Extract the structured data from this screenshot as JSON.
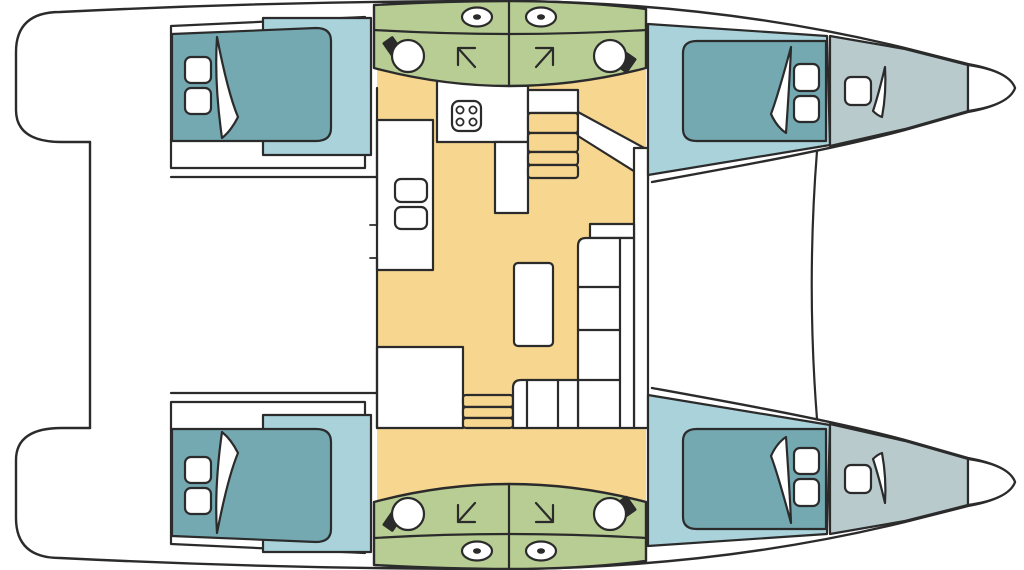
{
  "diagram": {
    "type": "catamaran-floor-plan",
    "orientation": {
      "bow": "right",
      "stern": "left"
    },
    "palette": {
      "outline": "#2b2b2b",
      "hull_white": "#ffffff",
      "floor_orange": "#f7d78f",
      "bathroom_green": "#b8cd93",
      "cabin_teal": "#a9d2da",
      "bed_teal": "#74a9b2",
      "bow_gray": "#b9cacd"
    },
    "rooms": [
      {
        "name": "cockpit-aft",
        "fill": "hull_white"
      },
      {
        "name": "saloon-galley",
        "fill": "floor_orange"
      },
      {
        "name": "aft-cabin-top-hull",
        "fill": "cabin_teal"
      },
      {
        "name": "forward-cabin-top-hull",
        "fill": "cabin_teal"
      },
      {
        "name": "aft-cabin-bottom-hull",
        "fill": "cabin_teal"
      },
      {
        "name": "forward-cabin-bottom-hull",
        "fill": "cabin_teal"
      },
      {
        "name": "bathrooms-top-hull",
        "fill": "bathroom_green"
      },
      {
        "name": "bathrooms-bottom-hull",
        "fill": "bathroom_green"
      },
      {
        "name": "forepeak-top-hull",
        "fill": "bow_gray"
      },
      {
        "name": "forepeak-bottom-hull",
        "fill": "bow_gray"
      },
      {
        "name": "foredeck",
        "fill": "hull_white"
      }
    ],
    "fixtures": [
      "stove-4-burners",
      "galley-double-sink",
      "dinette-table",
      "l-shaped-sofa",
      "staircase-top-hull",
      "staircase-bottom-hull",
      "double-bed-x4",
      "pillows-2-per-bed",
      "duvet-fold-per-bed",
      "toilet-x4",
      "washbasin-with-faucet-x4",
      "door-swing-arrow-x4",
      "forepeak-hatch-x2",
      "bow-tip-x2"
    ]
  }
}
